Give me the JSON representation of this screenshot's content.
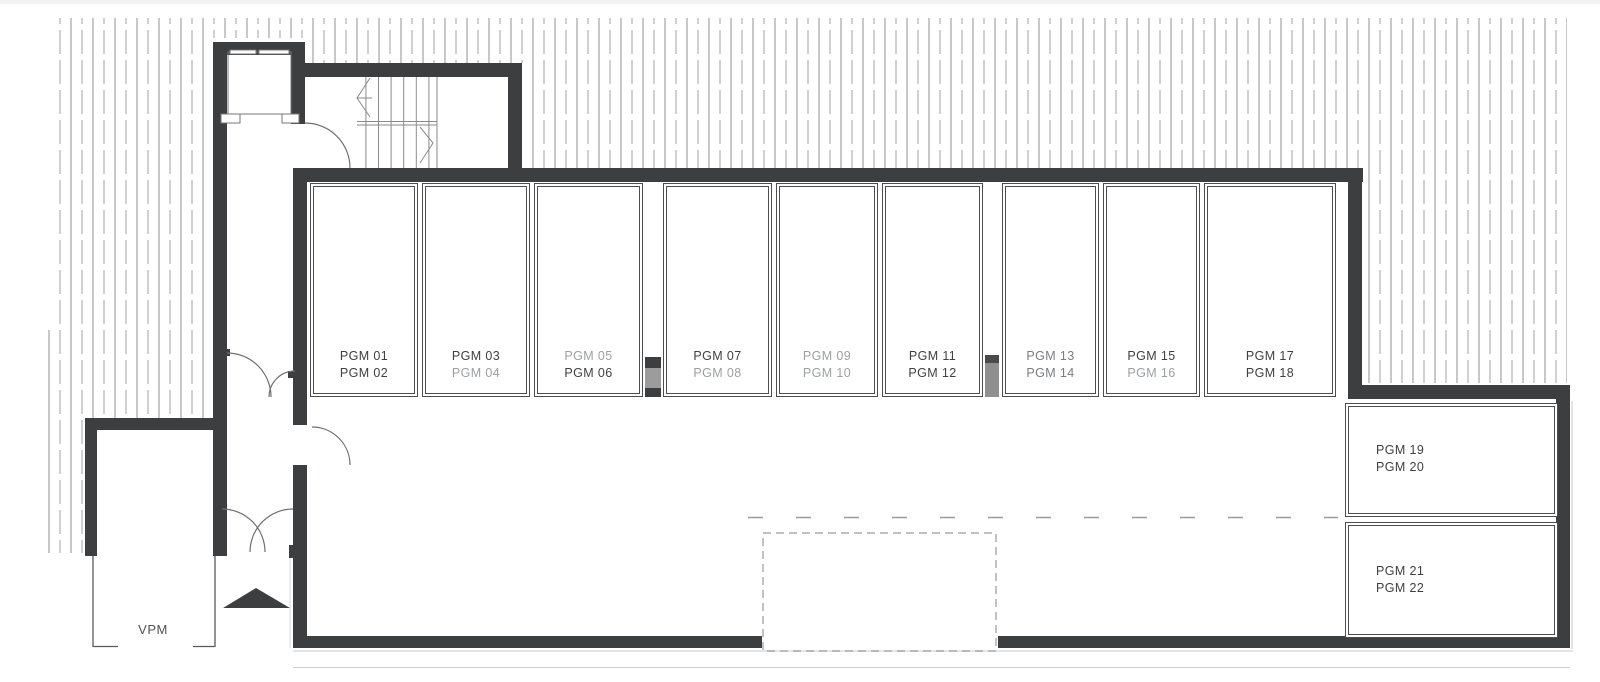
{
  "page": {
    "top_strip_color": "#f1f1f1",
    "background": "#ffffff"
  },
  "plan": {
    "wall_color": "#3d3e3f",
    "hatch_solid_line_color": "#919191",
    "hatch_dashed_line_color": "#a3a3a3",
    "stall_border_color": "#4d4d4d",
    "dashed_marking_color": "#9a9a9a",
    "column_gray": "#8f8f8f",
    "vestibule_label": {
      "text": "VPM",
      "color": "#525456"
    },
    "stalls": [
      {
        "lines": [
          {
            "text": "PGM 01",
            "color": "#404042"
          },
          {
            "text": "PGM 02",
            "color": "#404042"
          }
        ]
      },
      {
        "lines": [
          {
            "text": "PGM 03",
            "color": "#404042"
          },
          {
            "text": "PGM 04",
            "color": "#9da0a3"
          }
        ]
      },
      {
        "lines": [
          {
            "text": "PGM 05",
            "color": "#9da0a3"
          },
          {
            "text": "PGM 06",
            "color": "#404042"
          }
        ]
      },
      {
        "lines": [
          {
            "text": "PGM 07",
            "color": "#404042"
          },
          {
            "text": "PGM 08",
            "color": "#9da0a3"
          }
        ]
      },
      {
        "lines": [
          {
            "text": "PGM 09",
            "color": "#9da0a3"
          },
          {
            "text": "PGM 10",
            "color": "#9da0a3"
          }
        ]
      },
      {
        "lines": [
          {
            "text": "PGM 11",
            "color": "#404042"
          },
          {
            "text": "PGM 12",
            "color": "#404042"
          }
        ]
      },
      {
        "lines": [
          {
            "text": "PGM 13",
            "color": "#7b7d80"
          },
          {
            "text": "PGM 14",
            "color": "#7b7d80"
          }
        ]
      },
      {
        "lines": [
          {
            "text": "PGM 15",
            "color": "#404042"
          },
          {
            "text": "PGM 16",
            "color": "#9da0a3"
          }
        ]
      },
      {
        "lines": [
          {
            "text": "PGM 17",
            "color": "#404042"
          },
          {
            "text": "PGM 18",
            "color": "#404042"
          }
        ]
      },
      {
        "lines": [
          {
            "text": "PGM 19",
            "color": "#404042"
          },
          {
            "text": "PGM 20",
            "color": "#404042"
          }
        ]
      },
      {
        "lines": [
          {
            "text": "PGM 21",
            "color": "#404042"
          },
          {
            "text": "PGM 22",
            "color": "#404042"
          }
        ]
      }
    ]
  }
}
